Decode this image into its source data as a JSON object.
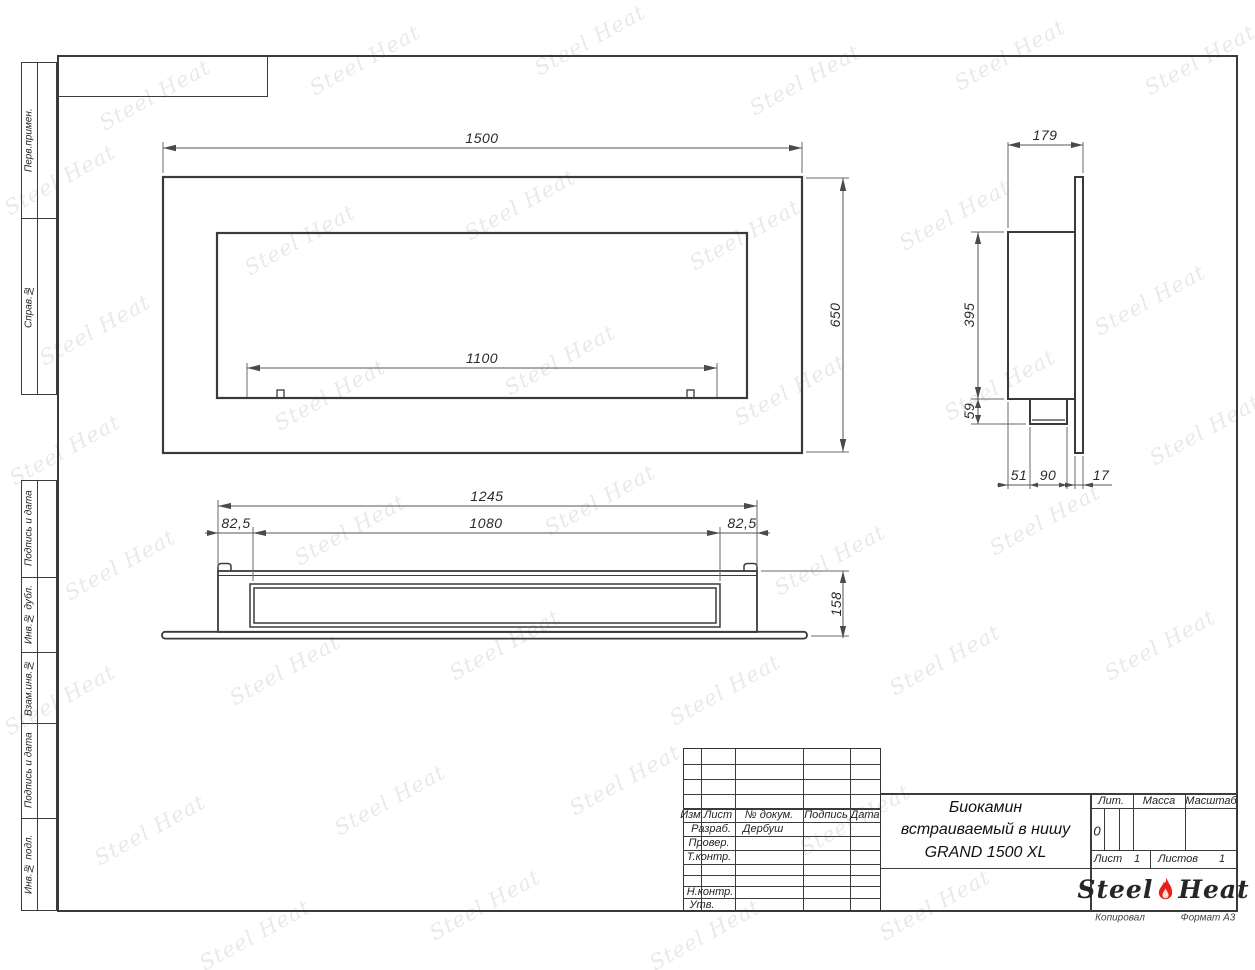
{
  "left_labels": [
    "Перв.примен.",
    "Справ.№",
    "Подпись и дата",
    "Инв.№ дубл.",
    "Взам.инв.№",
    "Подпись и дата",
    "Инв.№ подл."
  ],
  "title_block": {
    "header_cols": {
      "izm": "Изм.",
      "list": "Лист",
      "doc": "№ докум.",
      "sign": "Подпись",
      "date": "Дата"
    },
    "rows": {
      "razrab": "Разраб.",
      "prover": "Провер.",
      "tkontr": "Т.контр.",
      "nkontr": "Н.контр.",
      "utv": "Утв."
    },
    "developer": "Дербуш",
    "title1": "Биокамин",
    "title2": "встраиваемый в нишу",
    "title3": "GRAND 1500 XL",
    "lit": "Лит.",
    "lit_value": "0",
    "mass": "Масса",
    "scale": "Масштаб",
    "sheet": "Лист",
    "sheet_value": "1",
    "sheets": "Листов",
    "sheets_value": "1",
    "logo_left": "Steel",
    "logo_right": "Heat",
    "copied": "Копировал",
    "format": "Формат А3"
  },
  "watermark": {
    "text": "Steel Heat"
  },
  "dims": {
    "front": {
      "width": "1500",
      "height": "650",
      "opening": "1100"
    },
    "side": {
      "depth": "179",
      "body_height": "395",
      "tray": "59",
      "a": "51",
      "b": "90",
      "c": "17"
    },
    "bottom": {
      "body": "1245",
      "opening": "1080",
      "left": "82,5",
      "right": "82,5",
      "depth": "158"
    }
  },
  "colors": {
    "line": "#3c3c3c",
    "flame": "#e32119"
  }
}
